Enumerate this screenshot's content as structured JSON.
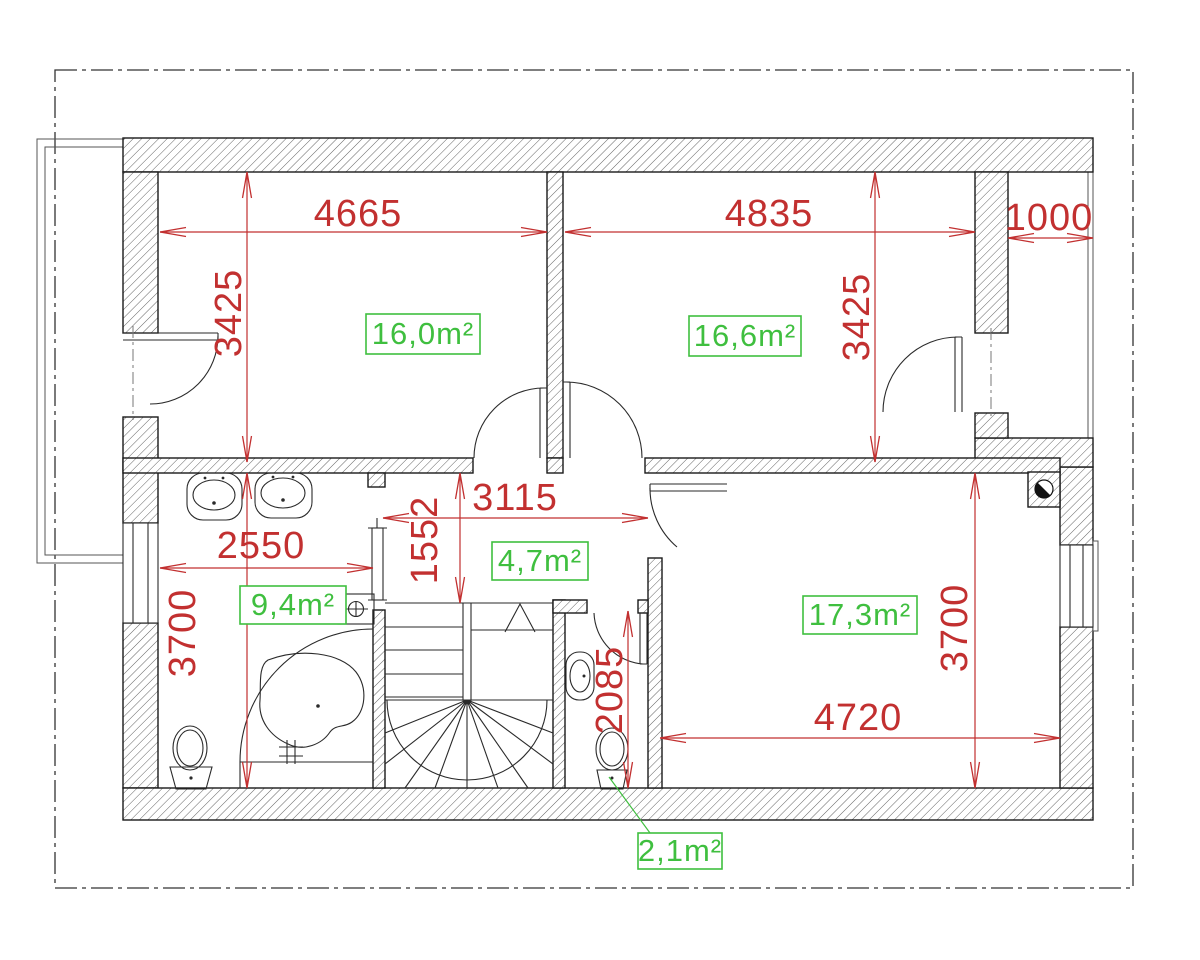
{
  "plan": {
    "area_labels": {
      "bedroom1": "16,0m²",
      "bedroom2": "16,6m²",
      "hall": "4,7m²",
      "bathroom": "9,4m²",
      "living": "17,3m²",
      "wc": "2,1m²"
    },
    "dimensions": {
      "bedroom1_width": "4665",
      "bedroom2_width": "4835",
      "loggia_width": "1000",
      "bedroom1_height": "3425",
      "bedroom2_height": "3425",
      "hall_width": "3115",
      "hall_depth": "1552",
      "bathroom_width": "2550",
      "bathroom_height": "3700",
      "living_width": "4720",
      "living_height": "3700",
      "wc_depth": "2085"
    },
    "colors": {
      "dimension_red": "#c23030",
      "area_green": "#3fbf3f",
      "wall_black": "#1a1a1a"
    }
  }
}
